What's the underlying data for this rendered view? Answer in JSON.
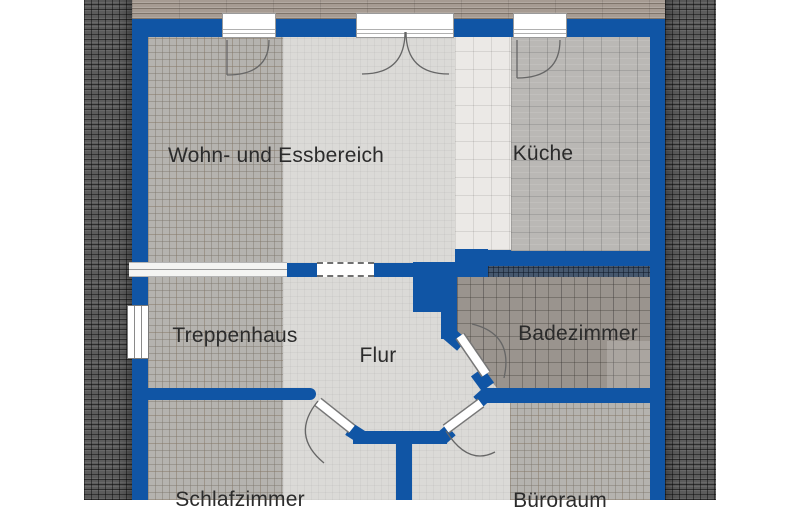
{
  "floorplan": {
    "type": "residential-floor-plan",
    "rooms": [
      {
        "label": "Wohn- und Essbereich"
      },
      {
        "label": "Küche"
      },
      {
        "label": "Treppenhaus"
      },
      {
        "label": "Flur"
      },
      {
        "label": "Badezimmer"
      },
      {
        "label": "Schlafzimmer"
      },
      {
        "label": "Büroraum"
      }
    ],
    "colors": {
      "wall": "#1055a5",
      "roof": "#5c5c5c",
      "ridge": "#a69b92",
      "bath_border": "#46586e"
    }
  }
}
